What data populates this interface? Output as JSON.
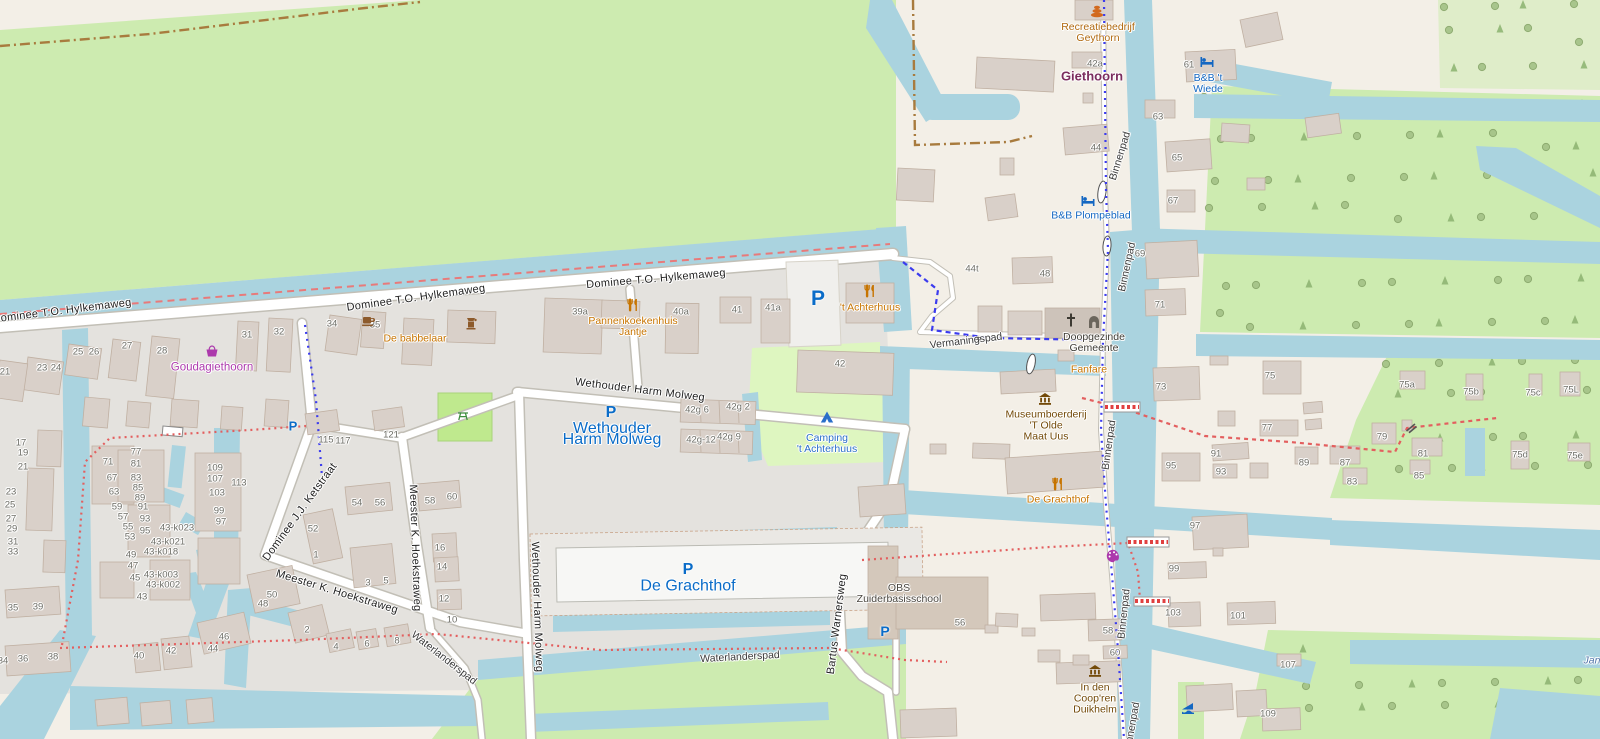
{
  "map": {
    "app": "slippy-map-viewer",
    "palette": {
      "water": "#aad3df",
      "grass": "#cdebb0",
      "campsite": "#def6c0",
      "pitch": "#bfe98e",
      "residential": "#e4e2de",
      "base": "#f3efe7",
      "building": "#d9d0c9",
      "building_stroke": "#c0b0a2",
      "road_fill": "#ffffff",
      "road_casing": "#c2bfb6",
      "route_red": "#e87a7a",
      "route_blue": "#3b3bee",
      "boundary": "#a87b3e",
      "street_text": "#1f1f1f",
      "housenumber_text": "#6d6d66",
      "poi_orange": "#c77400",
      "poi_blue": "#1467c2",
      "parking_blue": "#0a6cc8",
      "poi_purple": "#ac39ac",
      "poi_brown": "#734a08",
      "worship_text": "#3d3a33",
      "school_text": "#4a463f",
      "place_text": "#7b2d5e",
      "water_label": "#5577aa"
    },
    "street_labels": [
      [
        "Dominee T.O. Hylkemaweg",
        62,
        311,
        -7
      ],
      [
        "Dominee T.O. Hylkemaweg",
        416,
        298,
        -8
      ],
      [
        "Dominee T.O. Hylkemaweg",
        656,
        279,
        -5
      ],
      [
        "Wethouder Harm Molweg",
        640,
        390,
        7
      ],
      [
        "Wethouder Harm Molweg",
        537,
        607,
        88
      ],
      [
        "Meester K. Hoekstraweg",
        415,
        548,
        88
      ],
      [
        "Meester K. Hoekstraweg",
        337,
        592,
        17
      ],
      [
        "Dominee J.J. Ketstraat",
        300,
        512,
        -54
      ],
      [
        "Bartus Warnersweg",
        837,
        624,
        -83
      ],
      [
        "Waterlanderspad",
        740,
        657,
        -3
      ],
      [
        "Waterlanderspad",
        444,
        658,
        38
      ],
      [
        "Vermaningspad",
        966,
        341,
        -7
      ],
      [
        "Binnenpad",
        1120,
        156,
        -73
      ],
      [
        "Binnenpad",
        1127,
        267,
        -78
      ],
      [
        "Binnenpad",
        1109,
        445,
        -82
      ],
      [
        "Binnenpad",
        1124,
        614,
        -84
      ],
      [
        "Binnenpad",
        1132,
        727,
        -80
      ]
    ],
    "house_numbers": [
      [
        "42a",
        1095,
        64
      ],
      [
        "61",
        1189,
        65
      ],
      [
        "44",
        1096,
        148
      ],
      [
        "63",
        1158,
        117
      ],
      [
        "65",
        1177,
        158
      ],
      [
        "67",
        1173,
        201
      ],
      [
        "69",
        1140,
        254
      ],
      [
        "71",
        1160,
        305
      ],
      [
        "48",
        1045,
        274
      ],
      [
        "44t",
        972,
        269
      ],
      [
        "42",
        840,
        364
      ],
      [
        "34",
        332,
        324
      ],
      [
        "35",
        375,
        325
      ],
      [
        "39a",
        580,
        312
      ],
      [
        "40a",
        681,
        312
      ],
      [
        "41",
        737,
        310
      ],
      [
        "41a",
        773,
        308
      ],
      [
        "42g 6",
        697,
        410
      ],
      [
        "42g 2",
        738,
        407
      ],
      [
        "42g-12",
        701,
        440
      ],
      [
        "42g 9",
        729,
        437
      ],
      [
        "21",
        5,
        372
      ],
      [
        "23",
        42,
        368
      ],
      [
        "24",
        56,
        368
      ],
      [
        "25",
        78,
        352
      ],
      [
        "26",
        94,
        352
      ],
      [
        "27",
        127,
        346
      ],
      [
        "28",
        162,
        351
      ],
      [
        "31",
        247,
        335
      ],
      [
        "32",
        279,
        332
      ],
      [
        "17",
        21,
        443
      ],
      [
        "19",
        23,
        453
      ],
      [
        "21",
        23,
        467
      ],
      [
        "23",
        11,
        492
      ],
      [
        "25",
        10,
        505
      ],
      [
        "27",
        11,
        519
      ],
      [
        "29",
        12,
        529
      ],
      [
        "31",
        13,
        542
      ],
      [
        "33",
        13,
        552
      ],
      [
        "71",
        108,
        462
      ],
      [
        "77",
        136,
        452
      ],
      [
        "81",
        136,
        464
      ],
      [
        "67",
        112,
        478
      ],
      [
        "83",
        136,
        478
      ],
      [
        "63",
        114,
        492
      ],
      [
        "85",
        138,
        488
      ],
      [
        "89",
        140,
        498
      ],
      [
        "59",
        117,
        507
      ],
      [
        "91",
        143,
        507
      ],
      [
        "57",
        123,
        517
      ],
      [
        "93",
        145,
        519
      ],
      [
        "55",
        128,
        527
      ],
      [
        "95",
        145,
        531
      ],
      [
        "53",
        130,
        537
      ],
      [
        "49",
        131,
        555
      ],
      [
        "47",
        133,
        566
      ],
      [
        "45",
        135,
        578
      ],
      [
        "43",
        142,
        597
      ],
      [
        "43-k023",
        177,
        528
      ],
      [
        "43-k021",
        168,
        542
      ],
      [
        "43-k018",
        161,
        552
      ],
      [
        "43-k003",
        161,
        575
      ],
      [
        "43-k002",
        163,
        585
      ],
      [
        "109",
        215,
        468
      ],
      [
        "107",
        215,
        479
      ],
      [
        "113",
        239,
        483
      ],
      [
        "103",
        217,
        493
      ],
      [
        "99",
        219,
        511
      ],
      [
        "97",
        221,
        522
      ],
      [
        "115",
        326,
        440
      ],
      [
        "117",
        343,
        441
      ],
      [
        "121",
        391,
        435
      ],
      [
        "52",
        313,
        529
      ],
      [
        "1",
        316,
        555
      ],
      [
        "54",
        357,
        503
      ],
      [
        "56",
        380,
        503
      ],
      [
        "3",
        368,
        583
      ],
      [
        "5",
        386,
        581
      ],
      [
        "58",
        430,
        501
      ],
      [
        "60",
        452,
        497
      ],
      [
        "16",
        440,
        548
      ],
      [
        "14",
        442,
        567
      ],
      [
        "12",
        444,
        599
      ],
      [
        "10",
        452,
        620
      ],
      [
        "50",
        272,
        595
      ],
      [
        "48",
        263,
        604
      ],
      [
        "2",
        307,
        630
      ],
      [
        "4",
        336,
        647
      ],
      [
        "6",
        367,
        644
      ],
      [
        "8",
        397,
        641
      ],
      [
        "44",
        213,
        649
      ],
      [
        "46",
        224,
        637
      ],
      [
        "40",
        139,
        656
      ],
      [
        "42",
        171,
        651
      ],
      [
        "34",
        3,
        661
      ],
      [
        "36",
        23,
        659
      ],
      [
        "38",
        53,
        657
      ],
      [
        "35",
        13,
        608
      ],
      [
        "39",
        38,
        607
      ],
      [
        "56",
        960,
        623
      ],
      [
        "58",
        1108,
        631
      ],
      [
        "60",
        1115,
        653
      ],
      [
        "73",
        1161,
        387
      ],
      [
        "75",
        1270,
        376
      ],
      [
        "77",
        1267,
        428
      ],
      [
        "75a",
        1407,
        385
      ],
      [
        "75b",
        1471,
        392
      ],
      [
        "75c",
        1533,
        393
      ],
      [
        "75L",
        1571,
        390
      ],
      [
        "79",
        1382,
        437
      ],
      [
        "81",
        1423,
        454
      ],
      [
        "85",
        1419,
        476
      ],
      [
        "87",
        1345,
        463
      ],
      [
        "89",
        1304,
        463
      ],
      [
        "91",
        1216,
        454
      ],
      [
        "93",
        1221,
        472
      ],
      [
        "95",
        1171,
        466
      ],
      [
        "83",
        1352,
        482
      ],
      [
        "75d",
        1520,
        455
      ],
      [
        "75e",
        1575,
        456
      ],
      [
        "97",
        1195,
        526
      ],
      [
        "99",
        1174,
        569
      ],
      [
        "101",
        1238,
        616
      ],
      [
        "103",
        1173,
        613
      ],
      [
        "107",
        1288,
        665
      ],
      [
        "109",
        1268,
        714
      ]
    ],
    "pois": [
      {
        "name": "recreatiebedrijf-geythorn",
        "icon": "resort",
        "ix": 1097,
        "iy": 11,
        "lines": [
          "Recreatiebedrijf",
          "Geythorn"
        ],
        "tx": 1098,
        "ty": 27,
        "color": "#b0690f"
      },
      {
        "name": "place-giethoorn",
        "lines": [
          "Giethoorn"
        ],
        "tx": 1092,
        "ty": 76,
        "color": "#7b2d5e",
        "size": 13,
        "place": true
      },
      {
        "name": "bnb-t-wiede",
        "icon": "bed",
        "ix": 1207,
        "iy": 62,
        "lines": [
          "B&B 't",
          "Wiede"
        ],
        "tx": 1208,
        "ty": 78,
        "color": "#1467c2"
      },
      {
        "name": "bnb-plompeblad",
        "icon": "bed",
        "ix": 1088,
        "iy": 201,
        "lines": [
          "B&B Plompeblad"
        ],
        "tx": 1091,
        "ty": 216,
        "color": "#1467c2"
      },
      {
        "name": "de-babbelaar",
        "icon": "cafe",
        "ix": 368,
        "iy": 321,
        "lines": [
          "De babbelaar"
        ],
        "tx": 415,
        "ty": 339,
        "color": "#c77400"
      },
      {
        "name": "coffee-shop",
        "icon": "grinder",
        "ix": 471,
        "iy": 323,
        "lines": []
      },
      {
        "name": "pannenkoekenhuis-jantje",
        "icon": "restaurant",
        "ix": 633,
        "iy": 305,
        "lines": [
          "Pannenkoekenhuis",
          "Jantje"
        ],
        "tx": 633,
        "ty": 321,
        "color": "#c77400"
      },
      {
        "name": "t-achterhuus",
        "icon": "restaurant",
        "ix": 870,
        "iy": 291,
        "lines": [
          "'t Achterhuus"
        ],
        "tx": 870,
        "ty": 308,
        "color": "#c77400"
      },
      {
        "name": "camping-t-achterhuus",
        "icon": "tent",
        "ix": 827,
        "iy": 417,
        "lines": [
          "Camping",
          "'t Achterhuus"
        ],
        "tx": 827,
        "ty": 438,
        "color": "#2a6fc9"
      },
      {
        "name": "goudagiethoorn",
        "icon": "basket",
        "ix": 212,
        "iy": 351,
        "lines": [
          "Goudagiethoorn"
        ],
        "tx": 212,
        "ty": 368,
        "color": "#ac39ac",
        "size": 11.5
      },
      {
        "name": "parking-achterhuus",
        "icon": "parking",
        "ix": 818,
        "iy": 299,
        "size": 21,
        "lines": []
      },
      {
        "name": "parking-molweg",
        "icon": "parking",
        "ix": 611,
        "iy": 413,
        "size": 16,
        "lines": [
          "Wethouder",
          "Harm Molweg"
        ],
        "tx": 612,
        "ty": 428,
        "color": "#0a6cc8"
      },
      {
        "name": "parking-grachthof",
        "icon": "parking",
        "ix": 688,
        "iy": 570,
        "size": 16,
        "lines": [
          "De Grachthof"
        ],
        "tx": 688,
        "ty": 586,
        "color": "#0a6cc8"
      },
      {
        "name": "parking-school",
        "icon": "parking",
        "ix": 885,
        "iy": 631,
        "size": 14,
        "lines": []
      },
      {
        "name": "parking-ketstraat",
        "icon": "parking",
        "ix": 293,
        "iy": 426,
        "size": 13,
        "lines": []
      },
      {
        "name": "doopgezinde-gemeente",
        "icon": "church",
        "ix": 1071,
        "iy": 320,
        "icon2": "arch",
        "i2x": 1094,
        "i2y": 322,
        "lines": [
          "Doopgezinde",
          "Gemeente"
        ],
        "tx": 1094,
        "ty": 337,
        "color": "#3d3a33"
      },
      {
        "name": "fanfare",
        "lines": [
          "Fanfare"
        ],
        "tx": 1089,
        "ty": 370,
        "color": "#c77400"
      },
      {
        "name": "museumboerderij-t-olde-maat-uus",
        "icon": "museum",
        "ix": 1045,
        "iy": 399,
        "lines": [
          "Museumboerderij",
          "'T Olde",
          "Maat Uus"
        ],
        "tx": 1046,
        "ty": 415,
        "color": "#734a08"
      },
      {
        "name": "de-grachthof-restaurant",
        "icon": "restaurant",
        "ix": 1058,
        "iy": 484,
        "lines": [
          "De Grachthof"
        ],
        "tx": 1058,
        "ty": 500,
        "color": "#c77400"
      },
      {
        "name": "obs-zuiderbasisschool",
        "lines": [
          "OBS",
          "Zuiderbasisschool"
        ],
        "tx": 899,
        "ty": 588,
        "color": "#4a463f"
      },
      {
        "name": "in-den-coopren-duikhelm",
        "icon": "museum",
        "ix": 1095,
        "iy": 671,
        "lines": [
          "In den",
          "Coop'ren",
          "Duikhelm"
        ],
        "tx": 1095,
        "ty": 688,
        "color": "#734a08"
      },
      {
        "name": "artwork",
        "icon": "palette",
        "ix": 1113,
        "iy": 556,
        "lines": []
      },
      {
        "name": "slipway",
        "icon": "slipway",
        "ix": 1188,
        "iy": 707,
        "lines": []
      },
      {
        "name": "lock",
        "icon": "lock",
        "ix": 978,
        "iy": 339,
        "lines": []
      },
      {
        "name": "picnic-site",
        "icon": "picnic",
        "ix": 463,
        "iy": 415,
        "lines": []
      },
      {
        "name": "gate",
        "icon": "gate",
        "ix": 1411,
        "iy": 427,
        "lines": []
      },
      {
        "name": "water-label-jan",
        "lines": [
          "Jan"
        ],
        "tx": 1592,
        "ty": 661,
        "color": "#5577aa",
        "italic": true
      }
    ]
  }
}
